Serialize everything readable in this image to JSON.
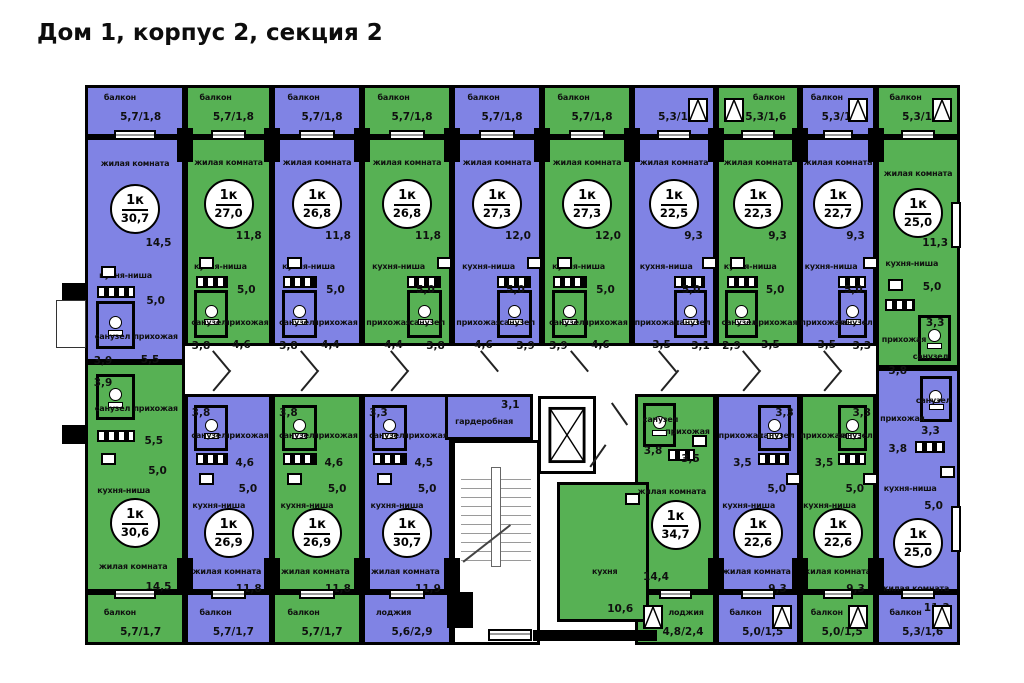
{
  "title": "Дом 1, корпус 2, секция 2",
  "colors": {
    "purple": "#8083e4",
    "green": "#57b154",
    "wall": "#000000",
    "background": "#ffffff"
  },
  "plan": {
    "apartments": [
      {
        "id": "top-1",
        "row": "top",
        "color": "purple",
        "type": "1к",
        "total": "30,7",
        "wc_side": "left",
        "balcony": {
          "name": "балкон",
          "area": "5,7/1,8",
          "casement": false,
          "cside": "right"
        },
        "rooms": {
          "living": {
            "name": "жилая комната",
            "area": "14,5"
          },
          "kitchen": {
            "name": "кухня-ниша",
            "area": "5,0"
          },
          "wc": {
            "name": "санузел",
            "area": "3,9"
          },
          "hall": {
            "name": "прихожая",
            "area": "5,5"
          }
        },
        "geo": {
          "x": 85,
          "y": 137,
          "w": 100,
          "h": 225,
          "bx": 85,
          "by": 85,
          "bw": 100,
          "bh": 52
        }
      },
      {
        "id": "top-2",
        "row": "top",
        "color": "green",
        "type": "1к",
        "total": "27,0",
        "wc_side": "left",
        "balcony": {
          "name": "балкон",
          "area": "5,7/1,8",
          "casement": false,
          "cside": "right"
        },
        "rooms": {
          "living": {
            "name": "жилая комната",
            "area": "11,8"
          },
          "kitchen": {
            "name": "кухня-ниша",
            "area": "5,0"
          },
          "wc": {
            "name": "санузел",
            "area": "3,8"
          },
          "hall": {
            "name": "прихожая",
            "area": "4,6"
          }
        },
        "geo": {
          "x": 185,
          "y": 137,
          "w": 87,
          "h": 209,
          "bx": 185,
          "by": 85,
          "bw": 87,
          "bh": 52
        }
      },
      {
        "id": "top-3",
        "row": "top",
        "color": "purple",
        "type": "1к",
        "total": "26,8",
        "wc_side": "left",
        "balcony": {
          "name": "балкон",
          "area": "5,7/1,8",
          "casement": false,
          "cside": "right"
        },
        "rooms": {
          "living": {
            "name": "жилая комната",
            "area": "11,8"
          },
          "kitchen": {
            "name": "кухня-ниша",
            "area": "5,0"
          },
          "wc": {
            "name": "санузел",
            "area": "3,8"
          },
          "hall": {
            "name": "прихожая",
            "area": "4,4"
          }
        },
        "geo": {
          "x": 272,
          "y": 137,
          "w": 90,
          "h": 209,
          "bx": 272,
          "by": 85,
          "bw": 90,
          "bh": 52
        }
      },
      {
        "id": "top-4",
        "row": "top",
        "color": "green",
        "type": "1к",
        "total": "26,8",
        "wc_side": "right",
        "balcony": {
          "name": "балкон",
          "area": "5,7/1,8",
          "casement": false,
          "cside": "right"
        },
        "rooms": {
          "living": {
            "name": "жилая комната",
            "area": "11,8"
          },
          "kitchen": {
            "name": "кухня-ниша",
            "area": "5,0"
          },
          "wc": {
            "name": "санузел",
            "area": "3,8"
          },
          "hall": {
            "name": "прихожая",
            "area": "4,4"
          }
        },
        "geo": {
          "x": 362,
          "y": 137,
          "w": 90,
          "h": 209,
          "bx": 362,
          "by": 85,
          "bw": 90,
          "bh": 52
        }
      },
      {
        "id": "top-5",
        "row": "top",
        "color": "purple",
        "type": "1к",
        "total": "27,3",
        "wc_side": "right",
        "balcony": {
          "name": "балкон",
          "area": "5,7/1,8",
          "casement": false,
          "cside": "right"
        },
        "rooms": {
          "living": {
            "name": "жилая комната",
            "area": "12,0"
          },
          "kitchen": {
            "name": "кухня-ниша",
            "area": "5,0"
          },
          "wc": {
            "name": "санузел",
            "area": "3,9"
          },
          "hall": {
            "name": "прихожая",
            "area": "4,6"
          }
        },
        "geo": {
          "x": 452,
          "y": 137,
          "w": 90,
          "h": 209,
          "bx": 452,
          "by": 85,
          "bw": 90,
          "bh": 52
        }
      },
      {
        "id": "top-6",
        "row": "top",
        "color": "green",
        "type": "1к",
        "total": "27,3",
        "wc_side": "left",
        "balcony": {
          "name": "балкон",
          "area": "5,7/1,8",
          "casement": false,
          "cside": "right"
        },
        "rooms": {
          "living": {
            "name": "жилая комната",
            "area": "12,0"
          },
          "kitchen": {
            "name": "кухня-ниша",
            "area": "5,0"
          },
          "wc": {
            "name": "санузел",
            "area": "3,9"
          },
          "hall": {
            "name": "прихожая",
            "area": "4,6"
          }
        },
        "geo": {
          "x": 542,
          "y": 137,
          "w": 90,
          "h": 209,
          "bx": 542,
          "by": 85,
          "bw": 90,
          "bh": 52
        }
      },
      {
        "id": "top-7",
        "row": "top",
        "color": "purple",
        "type": "1к",
        "total": "22,5",
        "wc_side": "right",
        "balcony": {
          "name": "",
          "area": "5,3/1,6",
          "casement": true,
          "cside": "right"
        },
        "rooms": {
          "living": {
            "name": "жилая комната",
            "area": "9,3"
          },
          "kitchen": {
            "name": "кухня-ниша",
            "area": "5,0"
          },
          "wc": {
            "name": "санузел",
            "area": "3,1"
          },
          "hall": {
            "name": "прихожая",
            "area": "3,5"
          }
        },
        "geo": {
          "x": 632,
          "y": 137,
          "w": 84,
          "h": 209,
          "bx": 632,
          "by": 85,
          "bw": 84,
          "bh": 52
        }
      },
      {
        "id": "top-8",
        "row": "top",
        "color": "green",
        "type": "1к",
        "total": "22,3",
        "wc_side": "left",
        "balcony": {
          "name": "балкон",
          "area": "5,3/1,6",
          "casement": true,
          "cside": "left"
        },
        "rooms": {
          "living": {
            "name": "жилая комната",
            "area": "9,3"
          },
          "kitchen": {
            "name": "кухня-ниша",
            "area": "5,0"
          },
          "wc": {
            "name": "санузел",
            "area": "2,9"
          },
          "hall": {
            "name": "прихожая",
            "area": "3,5"
          }
        },
        "geo": {
          "x": 716,
          "y": 137,
          "w": 84,
          "h": 209,
          "bx": 716,
          "by": 85,
          "bw": 84,
          "bh": 52
        }
      },
      {
        "id": "top-9",
        "row": "top",
        "color": "purple",
        "type": "1к",
        "total": "22,7",
        "wc_side": "right",
        "balcony": {
          "name": "балкон",
          "area": "5,3/1,6",
          "casement": true,
          "cside": "right"
        },
        "rooms": {
          "living": {
            "name": "жилая комната",
            "area": "9,3"
          },
          "kitchen": {
            "name": "кухня-ниша",
            "area": "5,0"
          },
          "wc": {
            "name": "санузел",
            "area": "3,3"
          },
          "hall": {
            "name": "прихожая",
            "area": "3,5"
          }
        },
        "geo": {
          "x": 800,
          "y": 137,
          "w": 76,
          "h": 209,
          "bx": 800,
          "by": 85,
          "bw": 76,
          "bh": 52
        }
      },
      {
        "id": "top-10",
        "row": "top",
        "color": "green",
        "type": "1к",
        "total": "25,0",
        "wc_side": "right",
        "custom": "t10",
        "balcony": {
          "name": "балкон",
          "area": "5,3/1,6",
          "casement": true,
          "cside": "right"
        },
        "rooms": {
          "living": {
            "name": "жилая комната",
            "area": "11,3"
          },
          "kitchen": {
            "name": "кухня-ниша",
            "area": "5,0"
          },
          "wc": {
            "name": "санузел",
            "area": "3,3"
          },
          "hall": {
            "name": "прихожая",
            "area": "3,8"
          }
        },
        "geo": {
          "x": 876,
          "y": 137,
          "w": 84,
          "h": 231,
          "bx": 876,
          "by": 85,
          "bw": 84,
          "bh": 52
        }
      },
      {
        "id": "bottom-1",
        "row": "bottom",
        "color": "green",
        "type": "1к",
        "total": "30,6",
        "wc_side": "left",
        "balcony": {
          "name": "балкон",
          "area": "5,7/1,7",
          "casement": false,
          "cside": "right"
        },
        "rooms": {
          "living": {
            "name": "жилая комната",
            "area": "14,5"
          },
          "kitchen": {
            "name": "кухня-ниша",
            "area": "5,0"
          },
          "wc": {
            "name": "санузел",
            "area": "3,9"
          },
          "hall": {
            "name": "прихожая",
            "area": "5,5"
          }
        },
        "geo": {
          "x": 85,
          "y": 362,
          "w": 100,
          "h": 230,
          "bx": 85,
          "by": 592,
          "bw": 100,
          "bh": 53
        }
      },
      {
        "id": "bottom-2",
        "row": "bottom",
        "color": "purple",
        "type": "1к",
        "total": "26,9",
        "wc_side": "left",
        "balcony": {
          "name": "балкон",
          "area": "5,7/1,7",
          "casement": false,
          "cside": "right"
        },
        "rooms": {
          "living": {
            "name": "жилая комната",
            "area": "11,8"
          },
          "kitchen": {
            "name": "кухня-ниша",
            "area": "5,0"
          },
          "wc": {
            "name": "санузел",
            "area": "3,8"
          },
          "hall": {
            "name": "прихожая",
            "area": "4,6"
          }
        },
        "geo": {
          "x": 185,
          "y": 394,
          "w": 87,
          "h": 198,
          "bx": 185,
          "by": 592,
          "bw": 87,
          "bh": 53
        }
      },
      {
        "id": "bottom-3",
        "row": "bottom",
        "color": "green",
        "type": "1к",
        "total": "26,9",
        "wc_side": "left",
        "balcony": {
          "name": "балкон",
          "area": "5,7/1,7",
          "casement": false,
          "cside": "right"
        },
        "rooms": {
          "living": {
            "name": "жилая комната",
            "area": "11,8"
          },
          "kitchen": {
            "name": "кухня-ниша",
            "area": "5,0"
          },
          "wc": {
            "name": "санузел",
            "area": "3,8"
          },
          "hall": {
            "name": "прихожая",
            "area": "4,6"
          }
        },
        "geo": {
          "x": 272,
          "y": 394,
          "w": 90,
          "h": 198,
          "bx": 272,
          "by": 592,
          "bw": 90,
          "bh": 53
        }
      },
      {
        "id": "bottom-4",
        "row": "bottom",
        "color": "purple",
        "type": "1к",
        "total": "30,7",
        "wc_side": "left",
        "balcony": {
          "name": "лоджия",
          "area": "5,6/2,9",
          "casement": false,
          "cside": "right"
        },
        "rooms": {
          "living": {
            "name": "жилая комната",
            "area": "11,9"
          },
          "kitchen": {
            "name": "кухня-ниша",
            "area": "5,0"
          },
          "wc": {
            "name": "санузел",
            "area": "3,3"
          },
          "hall": {
            "name": "прихожая",
            "area": "4,5"
          }
        },
        "geo": {
          "x": 362,
          "y": 394,
          "w": 90,
          "h": 198,
          "bx": 362,
          "by": 592,
          "bw": 90,
          "bh": 53
        }
      },
      {
        "id": "bottom-5",
        "row": "bottom",
        "color": "green",
        "type": "1к",
        "total": "34,7",
        "wc_side": "left",
        "custom": "b15",
        "balcony": {
          "name": "лоджия",
          "area": "4,8/2,4",
          "casement": true,
          "cside": "left"
        },
        "rooms": {
          "living": {
            "name": "жилая комната",
            "area": "14,4"
          },
          "kitchen": {
            "name": "кухня",
            "area": "10,6"
          },
          "wc": {
            "name": "санузел",
            "area": "3,8"
          },
          "hall": {
            "name": "прихожая",
            "area": "3,5"
          }
        },
        "geo": {
          "x": 635,
          "y": 394,
          "w": 81,
          "h": 198,
          "bx": 635,
          "by": 592,
          "bw": 81,
          "bh": 53
        }
      },
      {
        "id": "bottom-6",
        "row": "bottom",
        "color": "purple",
        "type": "1к",
        "total": "22,6",
        "wc_side": "right",
        "balcony": {
          "name": "балкон",
          "area": "5,0/1,5",
          "casement": true,
          "cside": "right"
        },
        "rooms": {
          "living": {
            "name": "жилая комната",
            "area": "9,3"
          },
          "kitchen": {
            "name": "кухня-ниша",
            "area": "5,0"
          },
          "wc": {
            "name": "санузел",
            "area": "3,3"
          },
          "hall": {
            "name": "прихожая",
            "area": "3,5"
          }
        },
        "geo": {
          "x": 716,
          "y": 394,
          "w": 84,
          "h": 198,
          "bx": 716,
          "by": 592,
          "bw": 84,
          "bh": 53
        }
      },
      {
        "id": "bottom-7",
        "row": "bottom",
        "color": "green",
        "type": "1к",
        "total": "22,6",
        "wc_side": "right",
        "balcony": {
          "name": "балкон",
          "area": "5,0/1,5",
          "casement": true,
          "cside": "right"
        },
        "rooms": {
          "living": {
            "name": "жилая комната",
            "area": "9,3"
          },
          "kitchen": {
            "name": "кухня-ниша",
            "area": "5,0"
          },
          "wc": {
            "name": "санузел",
            "area": "3,3"
          },
          "hall": {
            "name": "прихожая",
            "area": "3,5"
          }
        },
        "geo": {
          "x": 800,
          "y": 394,
          "w": 76,
          "h": 198,
          "bx": 800,
          "by": 592,
          "bw": 76,
          "bh": 53
        }
      },
      {
        "id": "bottom-8",
        "row": "bottom",
        "color": "purple",
        "type": "1к",
        "total": "25,0",
        "wc_side": "right",
        "custom": "b18",
        "balcony": {
          "name": "балкон",
          "area": "5,3/1,6",
          "casement": true,
          "cside": "right"
        },
        "rooms": {
          "living": {
            "name": "жилая комната",
            "area": "11,3"
          },
          "kitchen": {
            "name": "кухня-ниша",
            "area": "5,0"
          },
          "wc": {
            "name": "санузел",
            "area": "3,3"
          },
          "hall": {
            "name": "прихожая",
            "area": "3,8"
          }
        },
        "geo": {
          "x": 876,
          "y": 368,
          "w": 84,
          "h": 224,
          "bx": 876,
          "by": 592,
          "bw": 84,
          "bh": 53
        }
      }
    ],
    "extras": {
      "wardrobe": {
        "name": "гардеробная",
        "area": "3,1",
        "color": "purple",
        "geo": {
          "x": 445,
          "y": 394,
          "w": 88,
          "h": 46
        }
      },
      "kitchen_block": {
        "apartment_index": 14,
        "geo": {
          "x": 557,
          "y": 482,
          "w": 92,
          "h": 140
        }
      },
      "stairs": {
        "geo": {
          "x": 452,
          "y": 440,
          "w": 88,
          "h": 205
        }
      },
      "elevator": {
        "geo": {
          "x": 538,
          "y": 396,
          "w": 58,
          "h": 78
        }
      }
    }
  }
}
